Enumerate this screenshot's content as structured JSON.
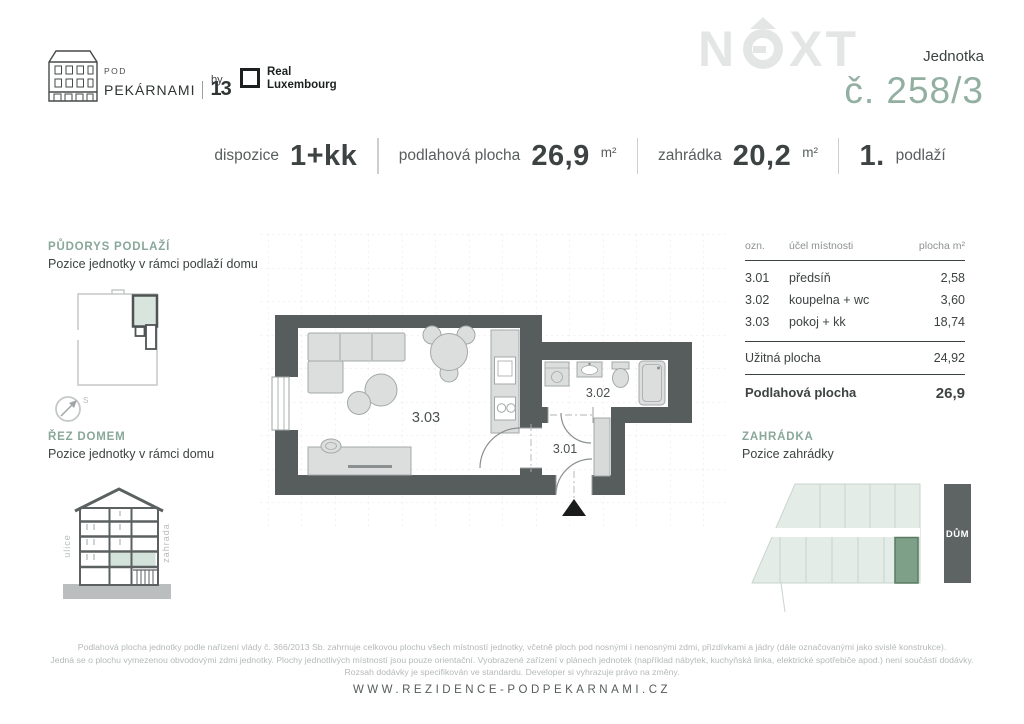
{
  "brand": {
    "pod": "POD",
    "name": "PEKÁRNAMI",
    "number": "13",
    "by": "by",
    "partner_line1": "Real",
    "partner_line2": "Luxembourg"
  },
  "watermark": {
    "n": "N",
    "x": "X",
    "t": "T"
  },
  "unit": {
    "label": "Jednotka",
    "number": "č. 258/3"
  },
  "specs": {
    "s1": {
      "label": "dispozice",
      "value": "1+kk"
    },
    "s2": {
      "label": "podlahová plocha",
      "value": "26,9",
      "unit": "m²"
    },
    "s3": {
      "label": "zahrádka",
      "value": "20,2",
      "unit": "m²"
    },
    "s4": {
      "value": "1.",
      "label": "podlaží"
    }
  },
  "sidebar": {
    "floorplan": {
      "title": "PŮDORYS PODLAŽÍ",
      "subtitle": "Pozice jednotky v rámci podlaží domu",
      "compass": "S"
    },
    "section": {
      "title": "ŘEZ DOMEM",
      "subtitle": "Pozice jednotky v rámci domu",
      "left_label": "ulice",
      "right_label": "zahrada"
    }
  },
  "plan": {
    "room1": "3.01",
    "room2": "3.02",
    "room3": "3.03"
  },
  "table": {
    "headers": [
      "ozn.",
      "účel místnosti",
      "plocha m²"
    ],
    "rows": [
      [
        "3.01",
        "předsíň",
        "2,58"
      ],
      [
        "3.02",
        "koupelna + wc",
        "3,60"
      ],
      [
        "3.03",
        "pokoj + kk",
        "18,74"
      ]
    ],
    "subtotal": {
      "label": "Užitná plocha",
      "value": "24,92"
    },
    "total": {
      "label": "Podlahová plocha",
      "value": "26,9"
    }
  },
  "garden": {
    "title": "ZAHRÁDKA",
    "subtitle": "Pozice zahrádky",
    "house_label": "DŮM"
  },
  "footer": {
    "line1": "Podlahová plocha jednotky podle nařízení vlády č. 366/2013 Sb. zahrnuje celkovou plochu všech místností jednotky, včetně ploch pod nosnými i nenosnými zdmi, přizdívkami a jádry (dále označovanými jako svislé konstrukce).",
    "line2": "Jedná se o plochu vymezenou obvodovými zdmi jednotky. Plochy jednotlivých místností jsou pouze orientační. Vyobrazené zařízení v plánech jednotek (například nábytek, kuchyňská linka, elektrické spotřebiče apod.) není součástí dodávky.",
    "line3": "Rozsah dodávky je specifikován ve standardu. Developer si vyhrazuje právo na změny.",
    "url": "WWW.REZIDENCE-PODPEKARNAMI.CZ"
  },
  "colors": {
    "accent_green": "#89a79a",
    "unit_green": "#92afa2",
    "wall_gray": "#575c5c",
    "plot_green": "#e4ece7",
    "highlight_green": "#7fa088",
    "house_gray": "#5e6363"
  }
}
